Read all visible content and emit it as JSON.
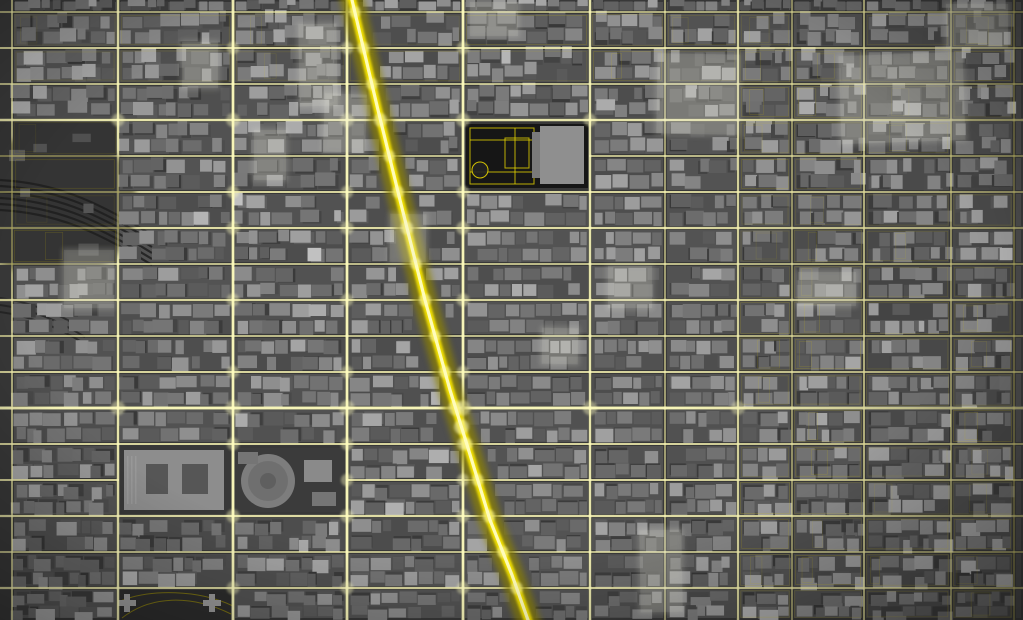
{
  "map": {
    "width": 1023,
    "height": 620,
    "colors": {
      "background": "#383838",
      "ground_gray": 80,
      "glow_outer": "#8f8400",
      "glow_mid": "#f6e400",
      "glow_core": "#fffdc0",
      "thin_line": "#cdb900",
      "tower_bloom": "#e8e8dc",
      "vignette": "#000000"
    },
    "avenues": [
      {
        "x": 12,
        "w": 2.0,
        "i": 0.7
      },
      {
        "x": 118,
        "w": 2.8,
        "i": 0.9
      },
      {
        "x": 233,
        "w": 3.2,
        "i": 1.0
      },
      {
        "x": 347,
        "w": 3.2,
        "i": 1.0
      },
      {
        "x": 463,
        "w": 3.2,
        "i": 1.0
      },
      {
        "x": 590,
        "w": 2.8,
        "i": 0.9
      },
      {
        "x": 665,
        "w": 1.8,
        "i": 0.6
      },
      {
        "x": 738,
        "w": 2.6,
        "i": 0.85
      },
      {
        "x": 792,
        "w": 1.8,
        "i": 0.6
      },
      {
        "x": 864,
        "w": 2.2,
        "i": 0.75
      },
      {
        "x": 951,
        "w": 2.0,
        "i": 0.7
      },
      {
        "x": 1014,
        "w": 1.4,
        "i": 0.5
      }
    ],
    "streets": [
      {
        "y": 12,
        "w": 2.0,
        "i": 0.65
      },
      {
        "y": 48,
        "w": 2.2,
        "i": 0.8
      },
      {
        "y": 84,
        "w": 2.0,
        "i": 0.75
      },
      {
        "y": 120,
        "w": 2.8,
        "i": 0.9
      },
      {
        "y": 156,
        "w": 2.0,
        "i": 0.75,
        "skip": [
          [
            463,
            590
          ]
        ]
      },
      {
        "y": 192,
        "w": 2.2,
        "i": 0.8
      },
      {
        "y": 228,
        "w": 2.6,
        "i": 0.85
      },
      {
        "y": 264,
        "w": 2.0,
        "i": 0.75
      },
      {
        "y": 300,
        "w": 2.4,
        "i": 0.8
      },
      {
        "y": 336,
        "w": 2.0,
        "i": 0.75
      },
      {
        "y": 372,
        "w": 2.2,
        "i": 0.8
      },
      {
        "y": 408,
        "w": 3.4,
        "i": 1.0
      },
      {
        "y": 444,
        "w": 2.2,
        "i": 0.8
      },
      {
        "y": 480,
        "w": 2.2,
        "i": 0.8,
        "skip": [
          [
            118,
            347
          ]
        ]
      },
      {
        "y": 516,
        "w": 2.6,
        "i": 0.85
      },
      {
        "y": 552,
        "w": 2.0,
        "i": 0.75
      },
      {
        "y": 588,
        "w": 2.4,
        "i": 0.8
      }
    ],
    "broadway": {
      "w": 3.6,
      "i": 1.0,
      "points": [
        [
          352,
          0
        ],
        [
          378,
          110
        ],
        [
          400,
          200
        ],
        [
          425,
          300
        ],
        [
          450,
          390
        ],
        [
          468,
          448
        ],
        [
          490,
          520
        ],
        [
          512,
          575
        ],
        [
          528,
          620
        ]
      ]
    },
    "landmarks": {
      "bryant_park": {
        "ground": [
          466,
          124,
          122,
          64
        ],
        "ground_color": "#161616",
        "path_color": "#e6d400",
        "outer_path": [
          470,
          128,
          64,
          56
        ],
        "h_path_lines": [
          140,
          172
        ],
        "v_path_line": 515,
        "lawn": [
          505,
          138,
          24,
          30
        ],
        "fountain": [
          480,
          170,
          8
        ],
        "library": [
          540,
          126,
          44,
          58
        ],
        "library_color": "#8f8f8f",
        "annex": [
          532,
          132,
          8,
          46
        ],
        "annex_color": "#7a7a7a"
      },
      "madison_square_garden": {
        "ground": [
          235,
          448,
          110,
          64
        ],
        "ground_color": "#3b3b3b",
        "circle": [
          268,
          481,
          27
        ],
        "outer_color": "#7d7d7d",
        "ring_r": 20,
        "ring_color": "#6f6f6f",
        "hub_r": 8,
        "hub_color": "#5f5f5f",
        "theater": [
          304,
          460,
          28,
          22
        ],
        "theater_color": "#8a8a8a",
        "boxes": [
          [
            238,
            452,
            20,
            12
          ],
          [
            312,
            492,
            24,
            14
          ]
        ]
      },
      "farley_building": {
        "rect": [
          124,
          450,
          100,
          60
        ],
        "color": "#8d8d8d",
        "courts": [
          [
            146,
            464,
            22,
            30
          ],
          [
            182,
            464,
            26,
            30
          ]
        ],
        "court_color": "#565656",
        "steps_color": "#9c9c9c"
      },
      "rail_yards": {
        "zone": [
          0,
          122,
          116,
          140
        ],
        "ground_color": "#343434",
        "track_color": "#1e1e1e",
        "tracks": [
          180,
          186,
          192,
          198,
          204,
          210
        ],
        "tracks_far": [
          298,
          305,
          312
        ]
      },
      "penn_south": {
        "zone": [
          118,
          588,
          115,
          32
        ],
        "ground_color": "#2d2d2d",
        "path_color": "#b5a400",
        "paths": [
          "M122,618 C150,596 190,594 231,614",
          "M118,602 C150,588 200,590 233,606"
        ],
        "crosses": [
          [
            127,
            603
          ],
          [
            212,
            603
          ]
        ],
        "cross_color": "#9a9a9a"
      }
    },
    "towers": [
      [
        297,
        22,
        42,
        86,
        -1
      ],
      [
        322,
        92,
        46,
        62,
        2
      ],
      [
        252,
        128,
        36,
        54,
        0
      ],
      [
        468,
        0,
        52,
        38,
        0
      ],
      [
        655,
        52,
        86,
        84,
        1
      ],
      [
        838,
        52,
        128,
        92,
        -2
      ],
      [
        944,
        2,
        66,
        48,
        0
      ],
      [
        388,
        212,
        40,
        52,
        1
      ],
      [
        606,
        264,
        48,
        46,
        0
      ],
      [
        62,
        248,
        54,
        62,
        0
      ],
      [
        796,
        270,
        62,
        38,
        0
      ],
      [
        540,
        326,
        40,
        40,
        1
      ],
      [
        638,
        528,
        46,
        86,
        -1
      ],
      [
        180,
        40,
        40,
        50,
        0
      ]
    ],
    "generator": {
      "seed": 20177,
      "palette": [
        88,
        96,
        104,
        112,
        120,
        130,
        140,
        152
      ],
      "no_build": [
        [
          463,
          120,
          590,
          192
        ],
        [
          233,
          444,
          347,
          516
        ],
        [
          118,
          444,
          233,
          516
        ],
        [
          0,
          120,
          118,
          264
        ],
        [
          118,
          588,
          233,
          620
        ]
      ],
      "outline_zones": [
        [
          738,
          0,
          1023,
          620
        ],
        [
          0,
          0,
          1023,
          84
        ],
        [
          0,
          120,
          118,
          264
        ]
      ],
      "broadway_clearance": 13
    }
  }
}
